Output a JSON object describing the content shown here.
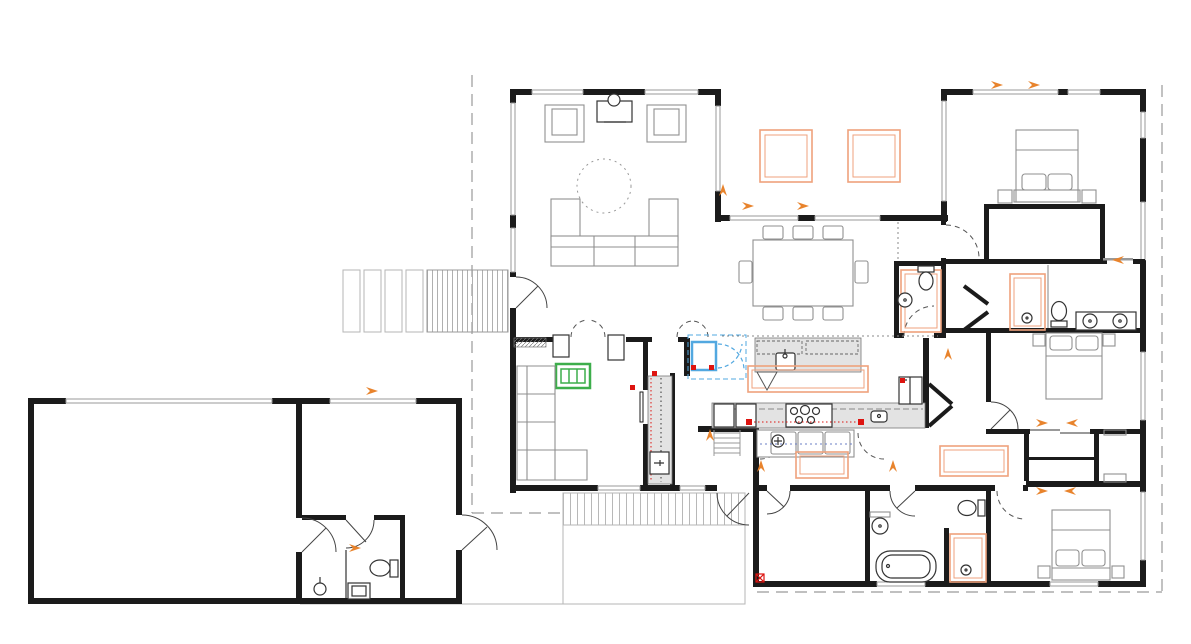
{
  "meta": {
    "title": "Single-storey residential floor plan drawing",
    "drawing_type": "architectural plan",
    "background": "#ffffff"
  },
  "colors": {
    "wall": "#1b1b1b",
    "furniture": "#8f8f8f",
    "fixture": "#333333",
    "counter_fill": "#e3e3e3",
    "boundary": "#9a9a9a",
    "deck_line": "#b5b5b5",
    "orange": "#e8832c",
    "orange_light": "#efa27c",
    "red": "#dd1410",
    "green": "#3dae4b",
    "blue": "#52a8e0",
    "paper": "#ffffff"
  },
  "regions": {
    "garage": "large empty double garage, west wing",
    "mudroom": "utility room with WC east of garage",
    "living": "living room with sectional sofa, two armchairs, media unit",
    "courtyard": "open courtyard with two orange skylight squares",
    "dining": "eight-seat dining table",
    "kitchen": "island with sink, rear counter with five-burner cooktop, fridge",
    "scullery": "grey pantry corridor with appliance",
    "lounge": "second lounge with L-shaped sofa and green window unit",
    "master_suite": "bedroom, walk-in wardrobe, ensuite with shower / wc / double vanity",
    "bedroom_2": "middle bedroom with double bed",
    "bedroom_3": "south-east bedroom with double bed",
    "bedroom_4": "south room, empty",
    "bathroom_main": "bathtub, basin, wc, shower",
    "wc_dining": "powder room with wc and basin",
    "deck": "timber deck ramp, paver path, south patio deck"
  },
  "symbols": {
    "beds": 3,
    "sofas": 3,
    "armchairs": 2,
    "dining_seats": 8,
    "bathtubs": 1,
    "showers": 3,
    "toilets": 5,
    "basins": 8,
    "cooktop_burners": 5,
    "wardrobe_boxes": 4
  },
  "accents": {
    "orange_rectangles": 8,
    "orange_direction_arrows": 16,
    "red_power_marks": 8,
    "green_window_unit": 1,
    "blue_fireplace_unit": 1,
    "boundary_dashed_lines": 4
  }
}
